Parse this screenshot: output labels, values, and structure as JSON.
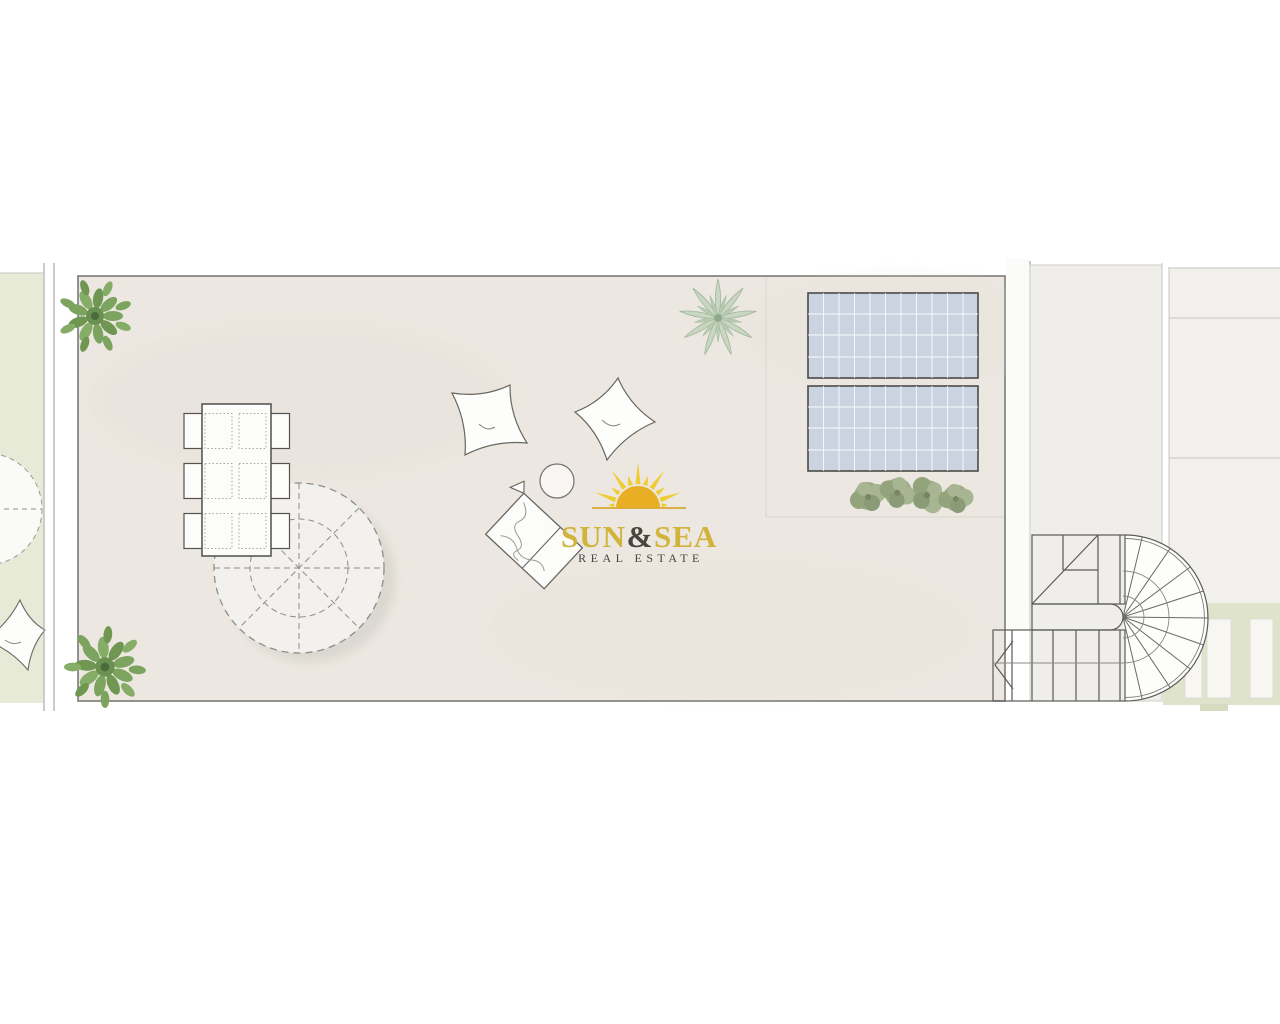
{
  "logo": {
    "word_sun": "SUN",
    "ampersand": "&",
    "word_sea": "SEA",
    "subtitle": "REAL ESTATE",
    "colors": {
      "gold": "#d2b43c",
      "dark": "#49443d",
      "sun_disc": "#e8af25",
      "sun_rays": "#f0cc33",
      "horizon": "#d9a92e"
    }
  },
  "plan": {
    "colors": {
      "terrace_floor": "#ece8e1",
      "garden_green": "#e7ead6",
      "deck_green": "#dfe3cb",
      "stairwell_floor": "#f0eeea",
      "neighbor_floor": "#f2f0ed",
      "wall_white": "#fbfbf9",
      "solar_panel": "#ccd3e0",
      "umbrella_fill": "#f3f1ed",
      "plant_bright": "#7ca45f",
      "plant_pale": "#c9d7c2",
      "shrub_muted": "#9fae8a",
      "outline": "#5a5a58"
    },
    "terrace_items": [
      {
        "name": "dining-table",
        "chairs": 6
      },
      {
        "name": "parasol-dashed-circle",
        "count": 1
      },
      {
        "name": "bean-bag-cushion",
        "count": 2
      },
      {
        "name": "side-table-round",
        "count": 1
      },
      {
        "name": "sun-lounger",
        "count": 1
      },
      {
        "name": "solar-panel",
        "count": 2
      },
      {
        "name": "corner-plant-bright",
        "count": 2
      },
      {
        "name": "agave-plant-pale",
        "count": 1
      },
      {
        "name": "shrub-row",
        "count": 4
      }
    ],
    "right_wing": [
      {
        "name": "u-shaped-staircase",
        "flights": 2
      },
      {
        "name": "deck-plank",
        "count": 3
      }
    ],
    "left_strip": [
      {
        "name": "neighbor-parasol-partial",
        "count": 1
      },
      {
        "name": "neighbor-cushion-partial",
        "count": 1
      }
    ]
  }
}
